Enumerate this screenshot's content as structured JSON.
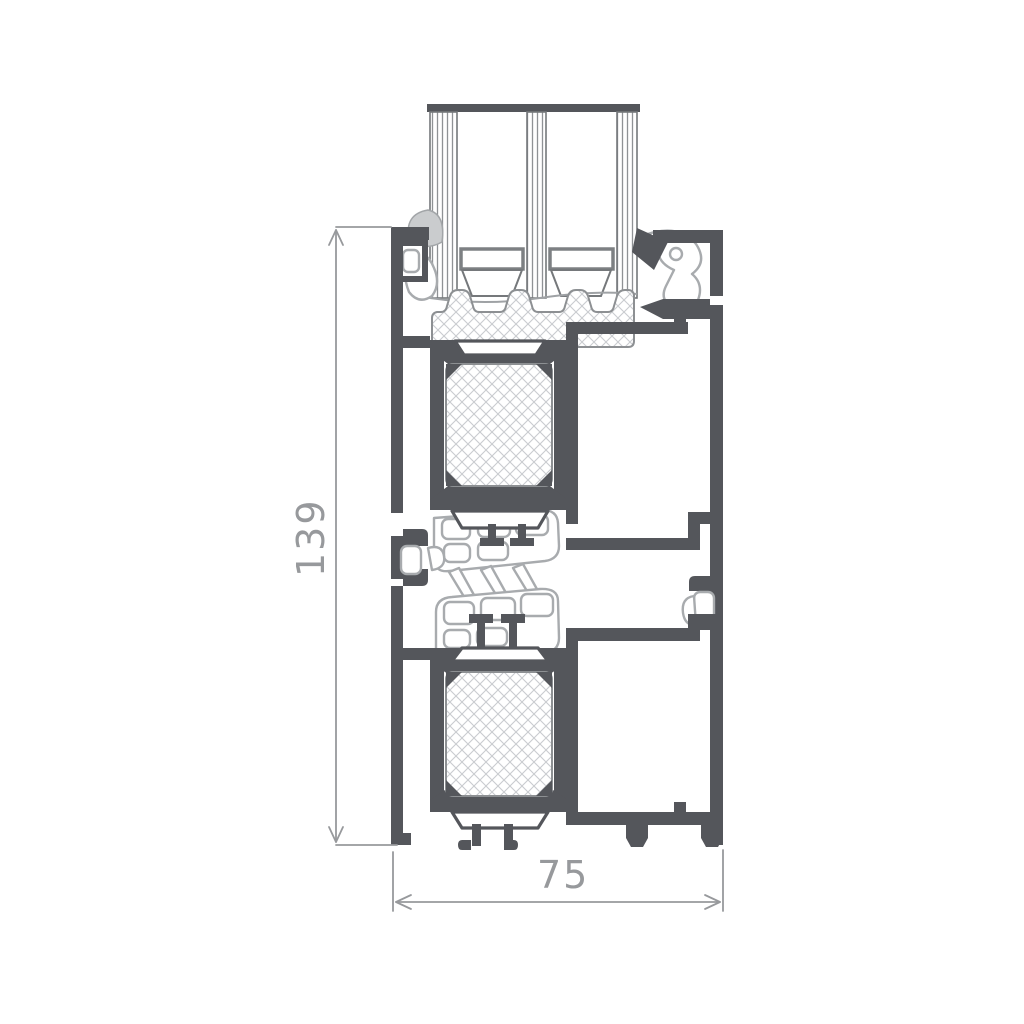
{
  "drawing": {
    "kind": "aluminium-window-profile-cross-section",
    "dimensions": {
      "height": {
        "label": "139",
        "orientation": "vertical"
      },
      "width": {
        "label": "75",
        "orientation": "horizontal"
      }
    }
  },
  "colors": {
    "aluminum": "#54565b",
    "gasket": "#a8abae",
    "dimension": "#97999c",
    "hatch": "#c9cccf",
    "background": "#ffffff"
  }
}
